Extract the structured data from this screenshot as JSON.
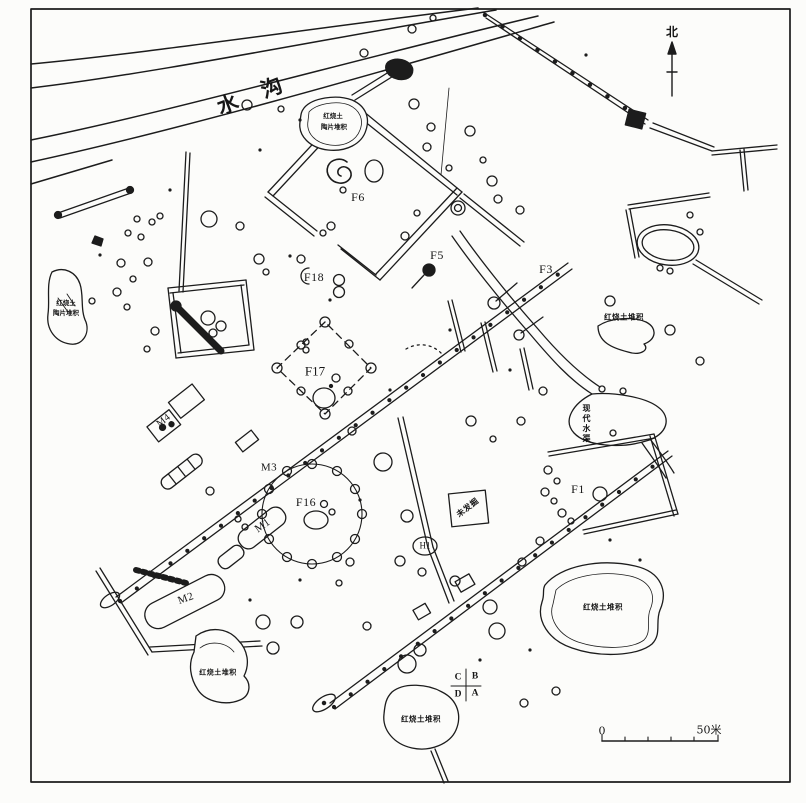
{
  "labels": {
    "river": "水沟",
    "north": "北",
    "scale_start": "0",
    "scale_end": "50米"
  },
  "features": {
    "f1": "F1",
    "f3": "F3",
    "f5": "F5",
    "f6": "F6",
    "f16": "F16",
    "f17": "F17",
    "f18": "F18",
    "h1": "H1",
    "m1": "M1",
    "m2": "M2",
    "m3": "M3",
    "m4": "M4"
  },
  "deposits": {
    "pond_top_l1": "红烧土",
    "pond_top_l2": "陶片堆积",
    "west_l1": "红烧土",
    "west_l2": "陶片堆积",
    "east": "红烧土堆积",
    "southeast": "红烧土堆积",
    "southwest": "红烧土堆积",
    "south": "红烧土堆积"
  },
  "annotations": {
    "canal": "现代水渠",
    "unexcavated": "未发掘",
    "quad_tl": "C",
    "quad_tr": "B",
    "quad_bl": "D",
    "quad_br": "A"
  }
}
